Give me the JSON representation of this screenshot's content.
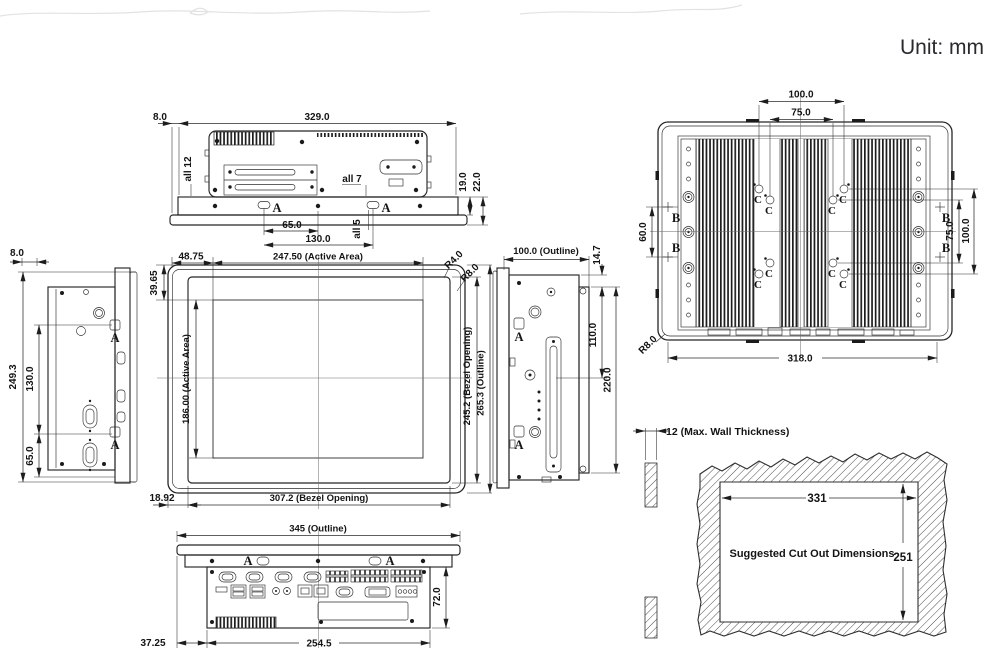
{
  "unit_note": "Unit: mm",
  "labels": {
    "a": "A",
    "b": "B",
    "c": "C"
  },
  "top_view": {
    "overhang": "8.0",
    "chassis_width": "329.0",
    "screw_note_side": "all 12",
    "screw_note_top": "all 7",
    "flange_height": "19.0",
    "total_height": "22.0",
    "slot_offset": "65.0",
    "slot_span": "130.0",
    "screw_note_bottom": "all 5"
  },
  "left_view": {
    "overhang": "8.0",
    "outline_height": "249.3",
    "port_span": "130.0",
    "port_offset": "65.0"
  },
  "front_view": {
    "active_offset_x": "48.75",
    "active_width": "247.50 (Active Area)",
    "bezel_radius": "R4.0",
    "outline_radius": "R8.0",
    "active_offset_y": "39.65",
    "active_height": "186.00 (Active Area)",
    "bezel_opening_height": "245.2 (Bezel Opening)",
    "outline_height": "265.3 (Outline)",
    "bezel_offset": "18.92",
    "bezel_opening_width": "307.2 (Bezel Opening)"
  },
  "right_view": {
    "outline_depth": "100.0 (Outline)",
    "top_offset": "14.7",
    "mount_span": "110.0",
    "bracket_span": "220.0"
  },
  "rear_view": {
    "vesa_width_100": "100.0",
    "vesa_width_75": "75.0",
    "bracket_pitch": "60.0",
    "vesa_height_75": "75.0",
    "vesa_height_100": "100.0",
    "body_width": "318.0",
    "corner_radius": "R8.0"
  },
  "bottom_view": {
    "outline_width": "345 (Outline)",
    "io_depth": "72.0",
    "side_offset": "37.25",
    "io_span": "254.5"
  },
  "cutout": {
    "wall_note": "12 (Max. Wall Thickness)",
    "width": "331",
    "height": "251",
    "caption": "Suggested Cut Out Dimensions"
  }
}
